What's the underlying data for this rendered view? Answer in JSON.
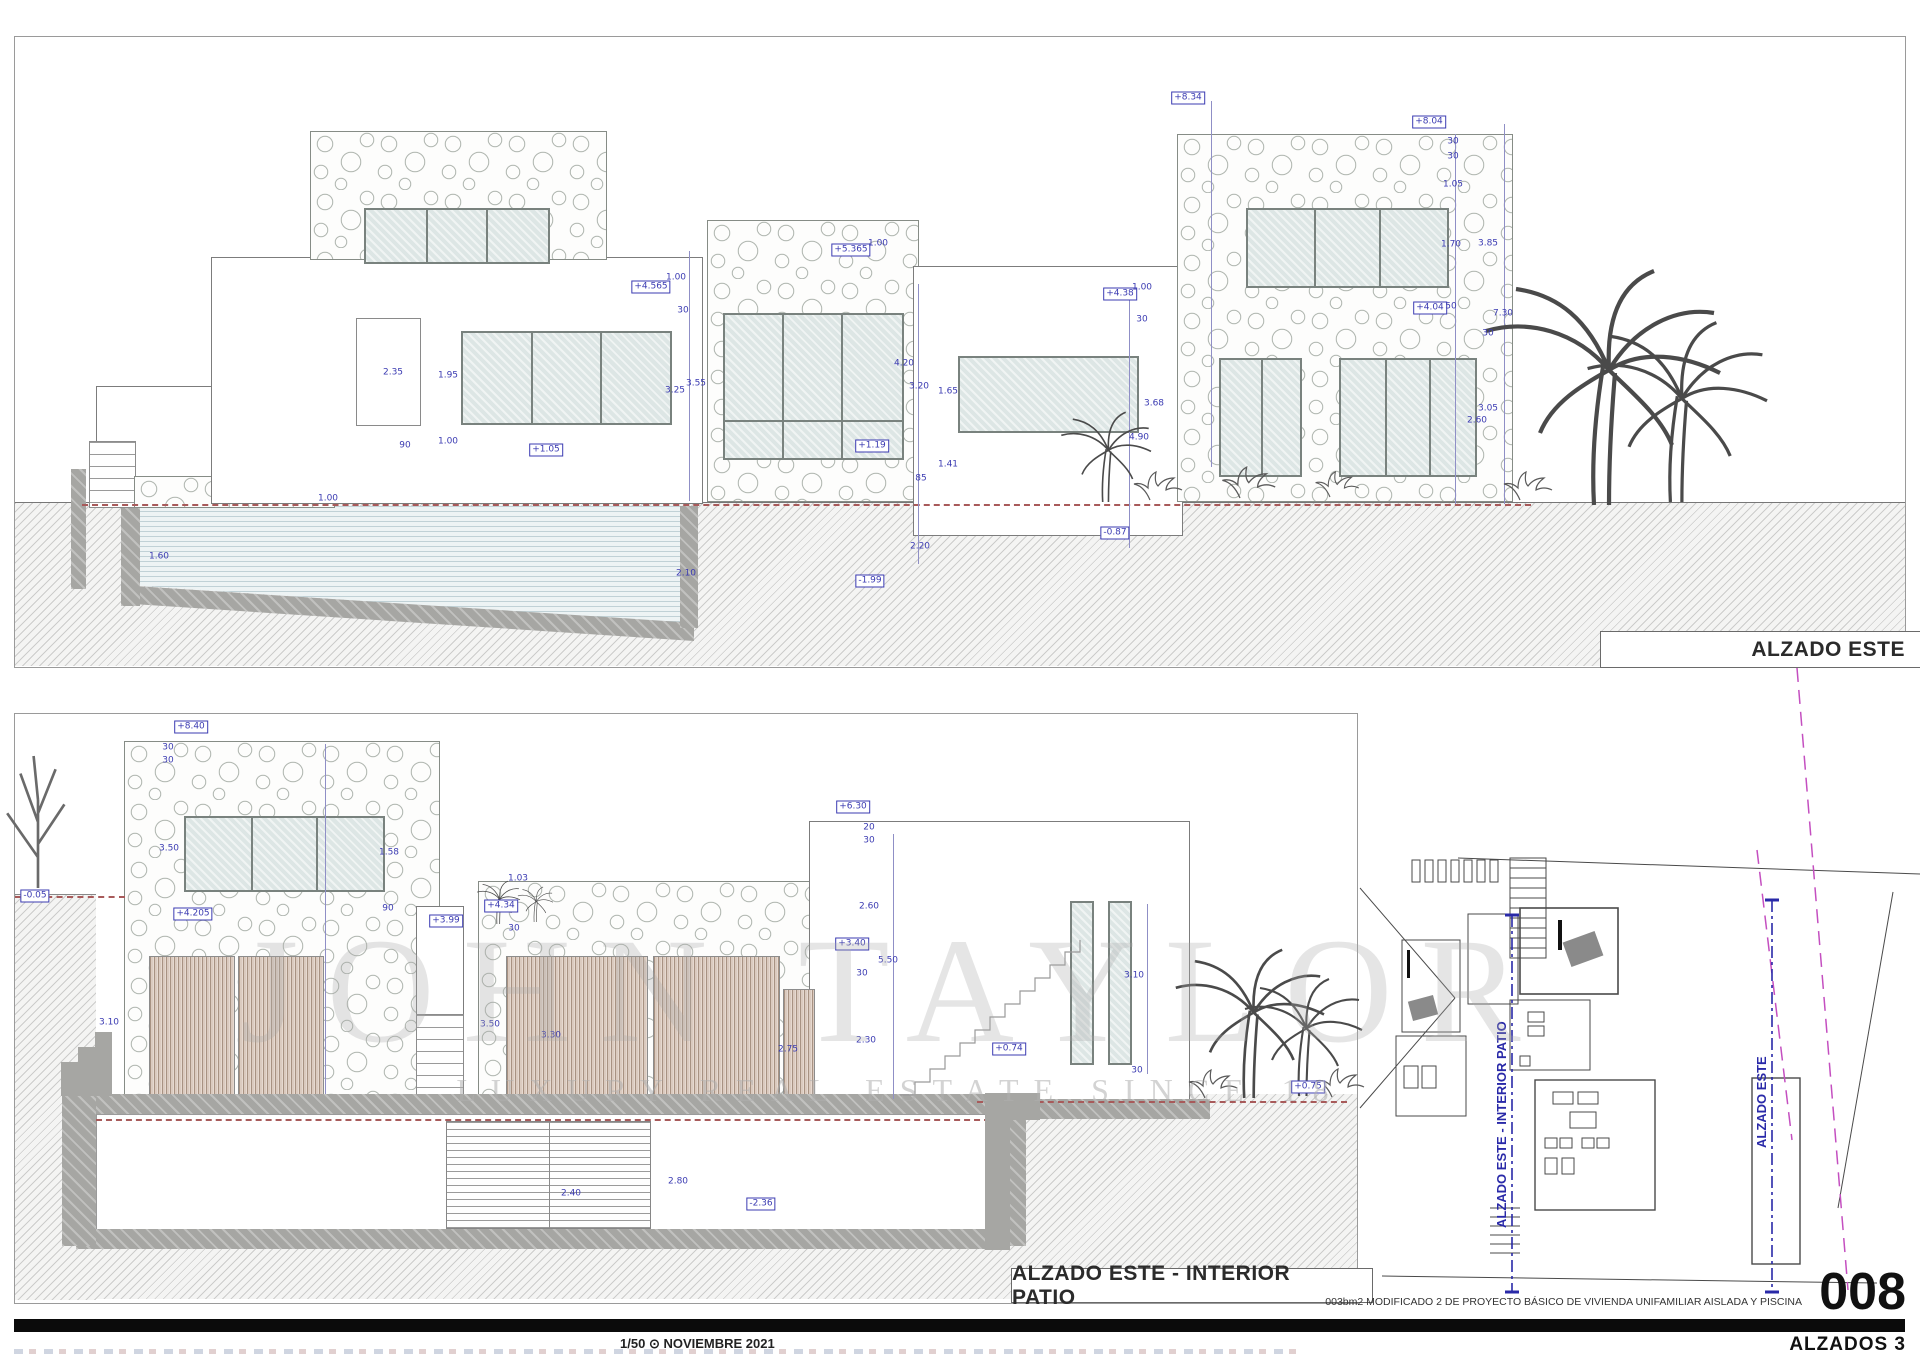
{
  "icons": {
    "clock": "⊙"
  },
  "top_elevation": {
    "title": "ALZADO ESTE",
    "labels": [
      {
        "x": 1173,
        "y": 61,
        "t": "+8.34",
        "box": true
      },
      {
        "x": 1414,
        "y": 85,
        "t": "+8.04",
        "box": true
      },
      {
        "x": 1438,
        "y": 105,
        "t": "30"
      },
      {
        "x": 1438,
        "y": 120,
        "t": "30"
      },
      {
        "x": 1438,
        "y": 148,
        "t": "1.05"
      },
      {
        "x": 1436,
        "y": 208,
        "t": "1.70"
      },
      {
        "x": 1473,
        "y": 207,
        "t": "3.85"
      },
      {
        "x": 1415,
        "y": 271,
        "t": "+4.04",
        "box": true
      },
      {
        "x": 1436,
        "y": 270,
        "t": "50"
      },
      {
        "x": 1488,
        "y": 277,
        "t": "7.30"
      },
      {
        "x": 1473,
        "y": 297,
        "t": "30"
      },
      {
        "x": 1473,
        "y": 372,
        "t": "3.05"
      },
      {
        "x": 1462,
        "y": 384,
        "t": "2.60"
      },
      {
        "x": 1139,
        "y": 367,
        "t": "3.68"
      },
      {
        "x": 836,
        "y": 213,
        "t": "+5.365",
        "box": true
      },
      {
        "x": 863,
        "y": 207,
        "t": "1.00"
      },
      {
        "x": 889,
        "y": 327,
        "t": "4.20"
      },
      {
        "x": 904,
        "y": 350,
        "t": "3.20"
      },
      {
        "x": 933,
        "y": 355,
        "t": "1.65"
      },
      {
        "x": 933,
        "y": 428,
        "t": "1.41"
      },
      {
        "x": 906,
        "y": 442,
        "t": "85"
      },
      {
        "x": 857,
        "y": 409,
        "t": "+1.19",
        "box": true
      },
      {
        "x": 1105,
        "y": 257,
        "t": "+4.38",
        "box": true
      },
      {
        "x": 1127,
        "y": 251,
        "t": "1.00"
      },
      {
        "x": 1127,
        "y": 283,
        "t": "30"
      },
      {
        "x": 1124,
        "y": 401,
        "t": "4.90"
      },
      {
        "x": 905,
        "y": 510,
        "t": "2.20"
      },
      {
        "x": 855,
        "y": 544,
        "t": "-1.99",
        "box": true
      },
      {
        "x": 1100,
        "y": 496,
        "t": "-0.87",
        "box": true
      },
      {
        "x": 378,
        "y": 336,
        "t": "2.35"
      },
      {
        "x": 390,
        "y": 409,
        "t": "90"
      },
      {
        "x": 433,
        "y": 405,
        "t": "1.00"
      },
      {
        "x": 433,
        "y": 339,
        "t": "1.95"
      },
      {
        "x": 531,
        "y": 413,
        "t": "+1.05",
        "box": true
      },
      {
        "x": 636,
        "y": 250,
        "t": "+4.565",
        "box": true
      },
      {
        "x": 661,
        "y": 241,
        "t": "1.00"
      },
      {
        "x": 668,
        "y": 274,
        "t": "30"
      },
      {
        "x": 681,
        "y": 347,
        "t": "3.55"
      },
      {
        "x": 660,
        "y": 354,
        "t": "3.25"
      },
      {
        "x": 313,
        "y": 462,
        "t": "1.00"
      },
      {
        "x": 144,
        "y": 520,
        "t": "1.60"
      },
      {
        "x": 671,
        "y": 537,
        "t": "2.10"
      }
    ]
  },
  "bottom_elevation": {
    "title": "ALZADO ESTE - INTERIOR PATIO",
    "labels": [
      {
        "x": 176,
        "y": 13,
        "t": "+8.40",
        "box": true
      },
      {
        "x": 153,
        "y": 34,
        "t": "30"
      },
      {
        "x": 153,
        "y": 47,
        "t": "30"
      },
      {
        "x": 154,
        "y": 135,
        "t": "3.50"
      },
      {
        "x": 374,
        "y": 139,
        "t": "1.58"
      },
      {
        "x": 373,
        "y": 195,
        "t": "90"
      },
      {
        "x": 178,
        "y": 200,
        "t": "+4.205",
        "box": true
      },
      {
        "x": 486,
        "y": 192,
        "t": "+4.34",
        "box": true
      },
      {
        "x": 503,
        "y": 165,
        "t": "1.03"
      },
      {
        "x": 499,
        "y": 215,
        "t": "30"
      },
      {
        "x": 431,
        "y": 207,
        "t": "+3.99",
        "box": true
      },
      {
        "x": 20,
        "y": 182,
        "t": "-0.05",
        "box": true
      },
      {
        "x": 838,
        "y": 93,
        "t": "+6.30",
        "box": true
      },
      {
        "x": 854,
        "y": 114,
        "t": "20"
      },
      {
        "x": 854,
        "y": 127,
        "t": "30"
      },
      {
        "x": 854,
        "y": 193,
        "t": "2.60"
      },
      {
        "x": 837,
        "y": 230,
        "t": "+3.40",
        "box": true
      },
      {
        "x": 873,
        "y": 247,
        "t": "5.50"
      },
      {
        "x": 847,
        "y": 260,
        "t": "30"
      },
      {
        "x": 851,
        "y": 327,
        "t": "2.30"
      },
      {
        "x": 994,
        "y": 335,
        "t": "+0.74",
        "box": true
      },
      {
        "x": 1122,
        "y": 357,
        "t": "30"
      },
      {
        "x": 1119,
        "y": 262,
        "t": "3.10"
      },
      {
        "x": 94,
        "y": 309,
        "t": "3.10"
      },
      {
        "x": 475,
        "y": 311,
        "t": "3.50"
      },
      {
        "x": 536,
        "y": 322,
        "t": "3.30"
      },
      {
        "x": 773,
        "y": 336,
        "t": "2.75"
      },
      {
        "x": 556,
        "y": 480,
        "t": "2.40"
      },
      {
        "x": 663,
        "y": 468,
        "t": "2.80"
      },
      {
        "x": 746,
        "y": 490,
        "t": "-2.36",
        "box": true
      },
      {
        "x": 1293,
        "y": 373,
        "t": "+0.75",
        "box": true
      }
    ]
  },
  "site_plan": {
    "section_label_1": "ALZADO ESTE - INTERIOR PATIO",
    "section_label_2": "ALZADO ESTE"
  },
  "title_block": {
    "project_note": "003bm2   MODIFICADO 2 DE PROYECTO BÁSICO DE VIVIENDA UNIFAMILIAR AISLADA Y PISCINA",
    "sheet_number": "008",
    "scale": "1/50",
    "date": "NOVIEMBRE 2021",
    "sheet_name": "ALZADOS 3"
  },
  "watermark": {
    "line1": "JOHN TAYLOR",
    "line2": "LUXURY REAL ESTATE SINCE 18"
  }
}
